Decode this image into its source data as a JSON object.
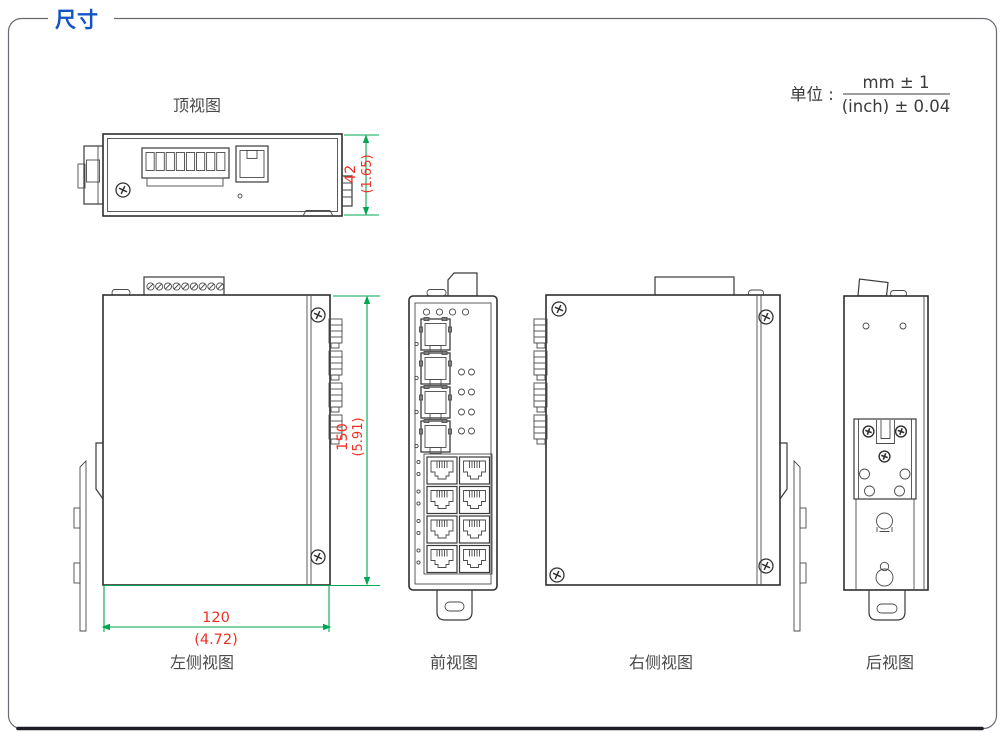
{
  "header": {
    "title": "尺寸"
  },
  "unit": {
    "label": "单位 :",
    "numerator": "mm ± 1",
    "denominator": "(inch) ± 0.04"
  },
  "views": {
    "top": {
      "label": "顶视图"
    },
    "left": {
      "label": "左侧视图"
    },
    "front": {
      "label": "前视图"
    },
    "right": {
      "label": "右侧视图"
    },
    "rear": {
      "label": "后视图"
    }
  },
  "dimensions": {
    "depth": {
      "mm": "42",
      "inch": "(1.65)"
    },
    "height": {
      "mm": "150",
      "inch": "(5.91)"
    },
    "width": {
      "mm": "120",
      "inch": "(4.72)"
    }
  },
  "colors": {
    "title_blue": "#1254C6",
    "dimension_lines_green": "#00A651",
    "dimension_text_red": "#EE3124",
    "drawing_stroke": "#3A3A3A"
  }
}
